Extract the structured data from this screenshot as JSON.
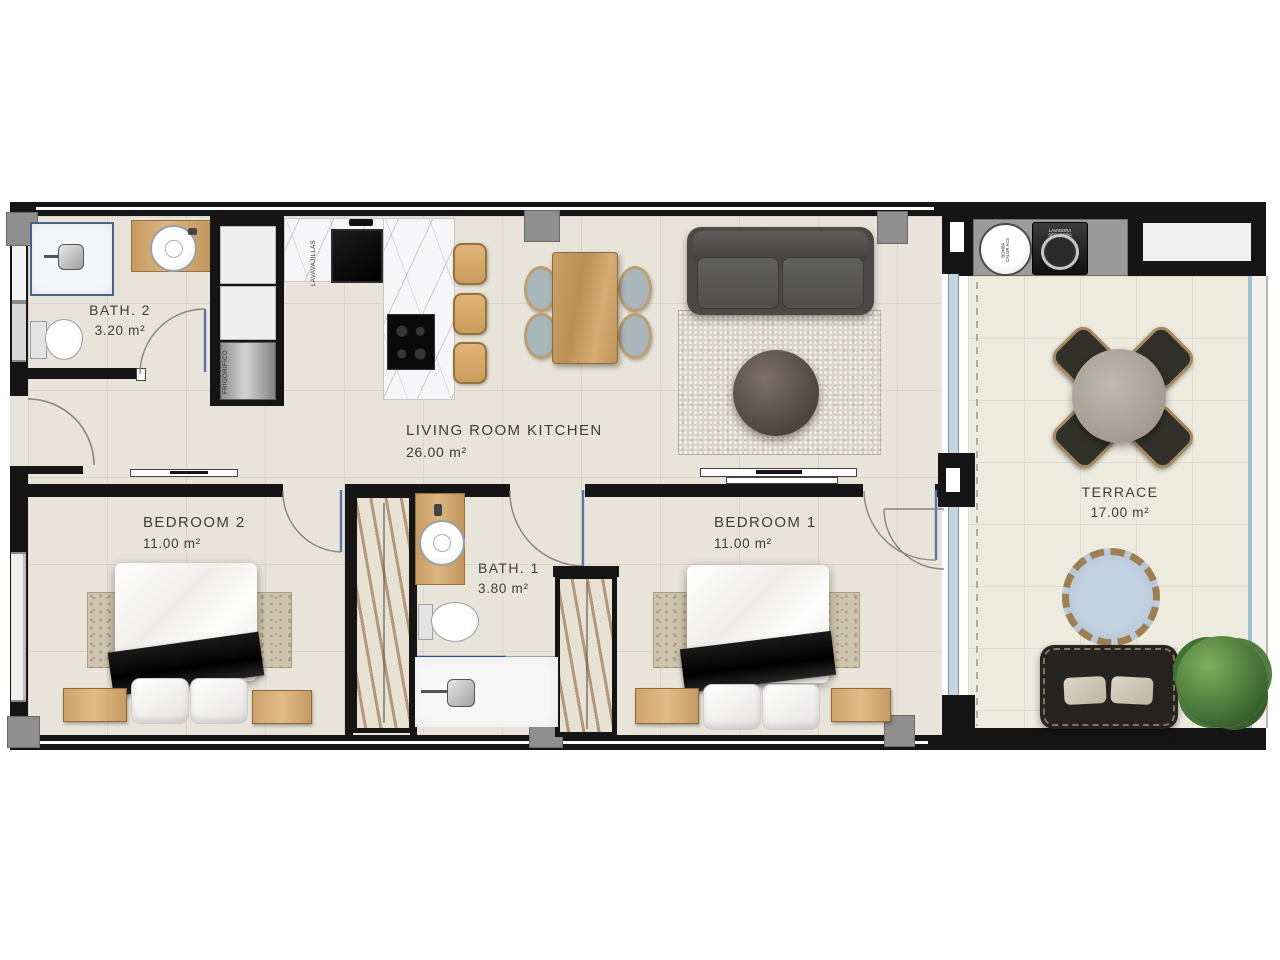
{
  "rooms": {
    "bath2": {
      "name": "BATH. 2",
      "area": "3.20 m²"
    },
    "living_kitchen": {
      "name": "LIVING ROOM KITCHEN",
      "area": "26.00 m²"
    },
    "bedroom2": {
      "name": "BEDROOM 2",
      "area": "11.00 m²"
    },
    "bath1": {
      "name": "BATH. 1",
      "area": "3.80 m²"
    },
    "bedroom1": {
      "name": "BEDROOM 1",
      "area": "11.00 m²"
    },
    "terrace": {
      "name": "TERRACE",
      "area": "17.00 m²"
    }
  },
  "appliances": {
    "dishwasher": "LAVAVAJILLAS",
    "fridge": "FRIGORIFICO",
    "heat_pump": "BOMBA CALOR ACS",
    "washer_dryer": "LAVADORA SECADORA"
  },
  "colors": {
    "wall": "#151515",
    "floor_tile": "#e9e4d9",
    "terrace_tile": "#edeade",
    "pillar": "#8f8f8f",
    "wood": "#c9a069",
    "door": "#5b74a8",
    "glass": "#9cc2d4",
    "plant": "#4c7a39"
  }
}
